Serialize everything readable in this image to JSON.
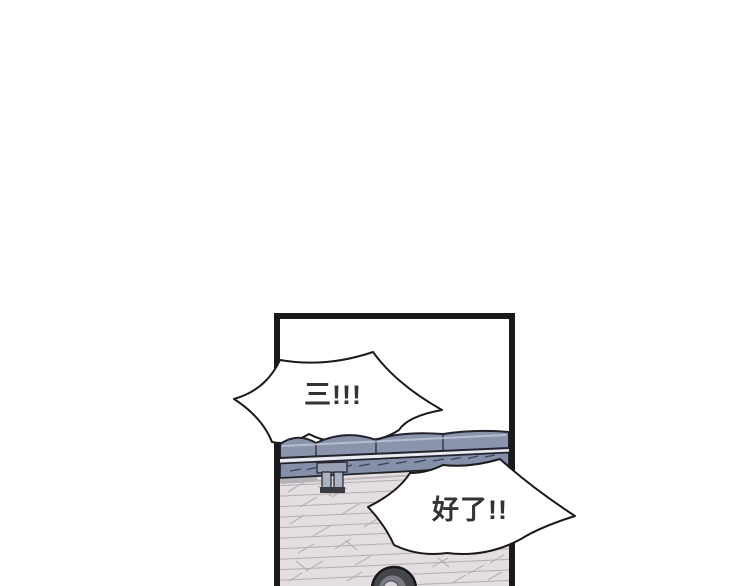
{
  "panel": {
    "bubbles": [
      {
        "name": "shout-bubble-left",
        "text": "三!!!"
      },
      {
        "name": "shout-bubble-right",
        "text": "好了!!"
      }
    ]
  },
  "colors": {
    "ink": "#1a1a1a",
    "bubble_fill": "#ffffff",
    "bubble_text": "#333333",
    "bench_seat": "#8b94ad",
    "bench_lower_plank": "#8490a9",
    "bench_highlight_strip": "#e8ebf2",
    "bench_leg": "#abb1c0",
    "bench_leg_bracket": "#99a0b2",
    "floor": "#e4dee1",
    "floor_line": "#b3acb0",
    "hair_outer": "#45454c",
    "hair_mid": "#7b7b84",
    "hair_center": "#d7d3d6"
  }
}
